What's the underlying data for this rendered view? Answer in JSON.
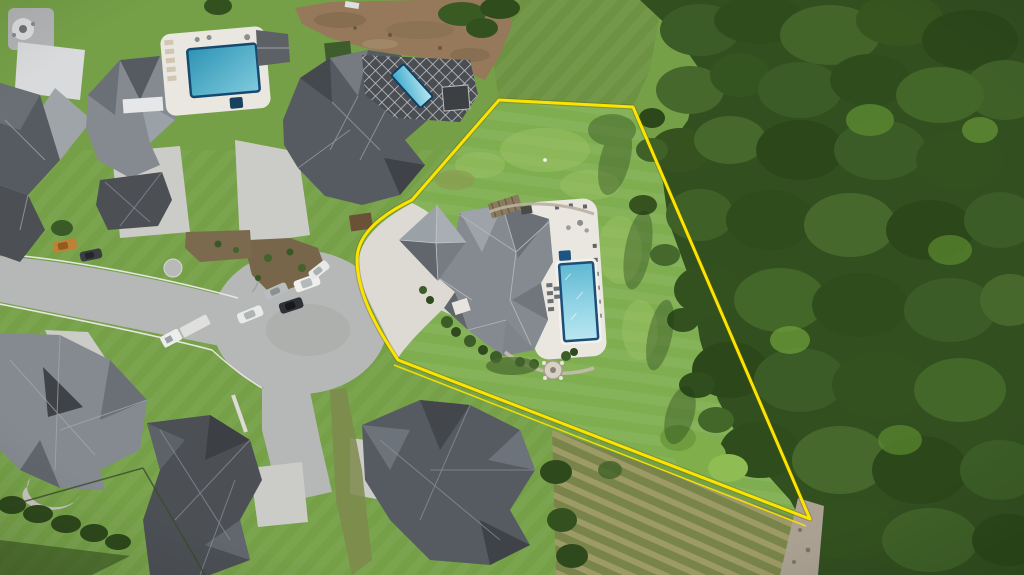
{
  "scene": {
    "type": "aerial-drone-photo",
    "subject": "estate lot with home and pool outlined by yellow property line",
    "features": [
      "cul-de-sac street",
      "neighboring luxury homes",
      "three swimming pools",
      "dense forest east of lot",
      "graded dirt area",
      "mowed lawns",
      "parked cars"
    ]
  },
  "boundary": {
    "label": "property-line",
    "color": "#fbe400",
    "main_path": "M499,100 L633,107 L810,519 L398,360 C378,330 358,295 357,262 C356,238 375,218 412,200 Z",
    "double_line_path": "M394,365 L806,526",
    "stroke_width": 3
  },
  "colors": {
    "boundary": "#fbe400",
    "lawn": "#75a047",
    "lawn_lot": "#7fae50",
    "field": "#6d9342",
    "forest": "#324f20",
    "dirt": "#95795a",
    "road": "#b5b8b6",
    "concrete": "#cbccc8",
    "apron": "#dcdad2",
    "deck": "#e9e7e0",
    "roof_light": "#9aa1a7",
    "roof_mid": "#848a90",
    "roof_dark": "#565b61",
    "roof_charcoal": "#4c5055",
    "pool_rim": "#1c4e77",
    "pool_deep": "#2d93b4",
    "pool_light": "#b9e7f1",
    "lattice_dark": "#4a4e52",
    "mulch": "#77664a",
    "scrub": "#79824a",
    "scrub_row": "#9f9a68",
    "path_tan": "#aaa193",
    "hedge": "#2e481c",
    "curb": "#e6e6e1",
    "stone": "#c3bcab",
    "shadow": "#1f3a16"
  },
  "objects": {
    "pools": [
      {
        "name": "neighbor-pool-west"
      },
      {
        "name": "neighbor-pool-north-lattice"
      },
      {
        "name": "subject-pool"
      }
    ],
    "vehicles": [
      {
        "name": "orange-car"
      },
      {
        "name": "dark-car"
      },
      {
        "name": "white-truck-trailer"
      },
      {
        "name": "white-sedan"
      },
      {
        "name": "black-suv"
      },
      {
        "name": "silver-car"
      },
      {
        "name": "white-suv"
      },
      {
        "name": "white-car"
      }
    ]
  }
}
